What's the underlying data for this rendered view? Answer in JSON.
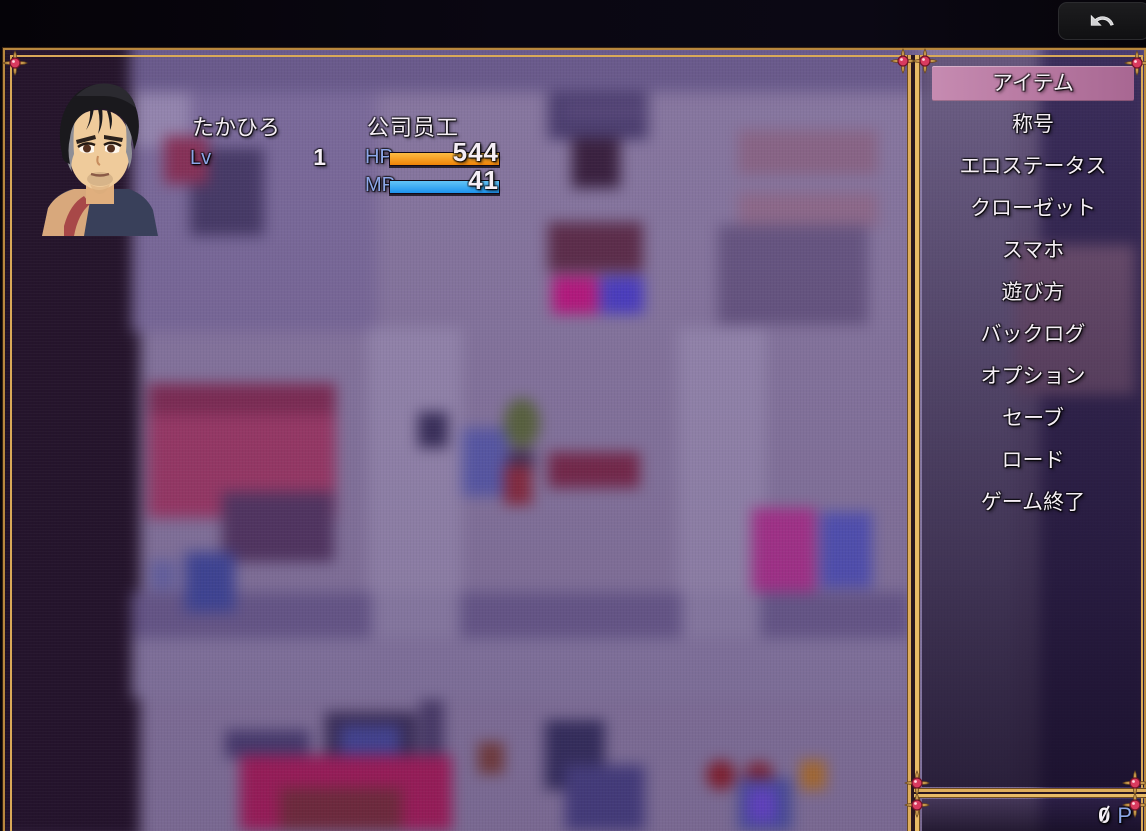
{
  "back_button": {
    "icon": "undo-arrow",
    "action": "return"
  },
  "player": {
    "name": "たかひろ",
    "class": "公司员工",
    "level_label": "Lv",
    "level": "1",
    "hp_label": "HP",
    "hp_value": "544",
    "hp_percent": 100,
    "mp_label": "MP",
    "mp_value": "41",
    "mp_percent": 100
  },
  "menu": {
    "items": [
      {
        "label": "アイテム",
        "selected": true
      },
      {
        "label": "称号",
        "selected": false
      },
      {
        "label": "エロステータス",
        "selected": false
      },
      {
        "label": "クローゼット",
        "selected": false
      },
      {
        "label": "スマホ",
        "selected": false
      },
      {
        "label": "遊び方",
        "selected": false
      },
      {
        "label": "バックログ",
        "selected": false
      },
      {
        "label": "オプション",
        "selected": false
      },
      {
        "label": "セーブ",
        "selected": false
      },
      {
        "label": "ロード",
        "selected": false
      },
      {
        "label": "ゲーム終了",
        "selected": false
      }
    ]
  },
  "currency": {
    "amount": "0",
    "unit": "P"
  },
  "colors": {
    "frame_gold": "#d9a958",
    "gem_red": "#e04663",
    "highlight_pink": "#b4749f",
    "hp_bar": "#f08408",
    "mp_bar": "#1d93ee",
    "label_blue": "#8da7e8",
    "map_overlay_purple": "#8c7da4"
  }
}
